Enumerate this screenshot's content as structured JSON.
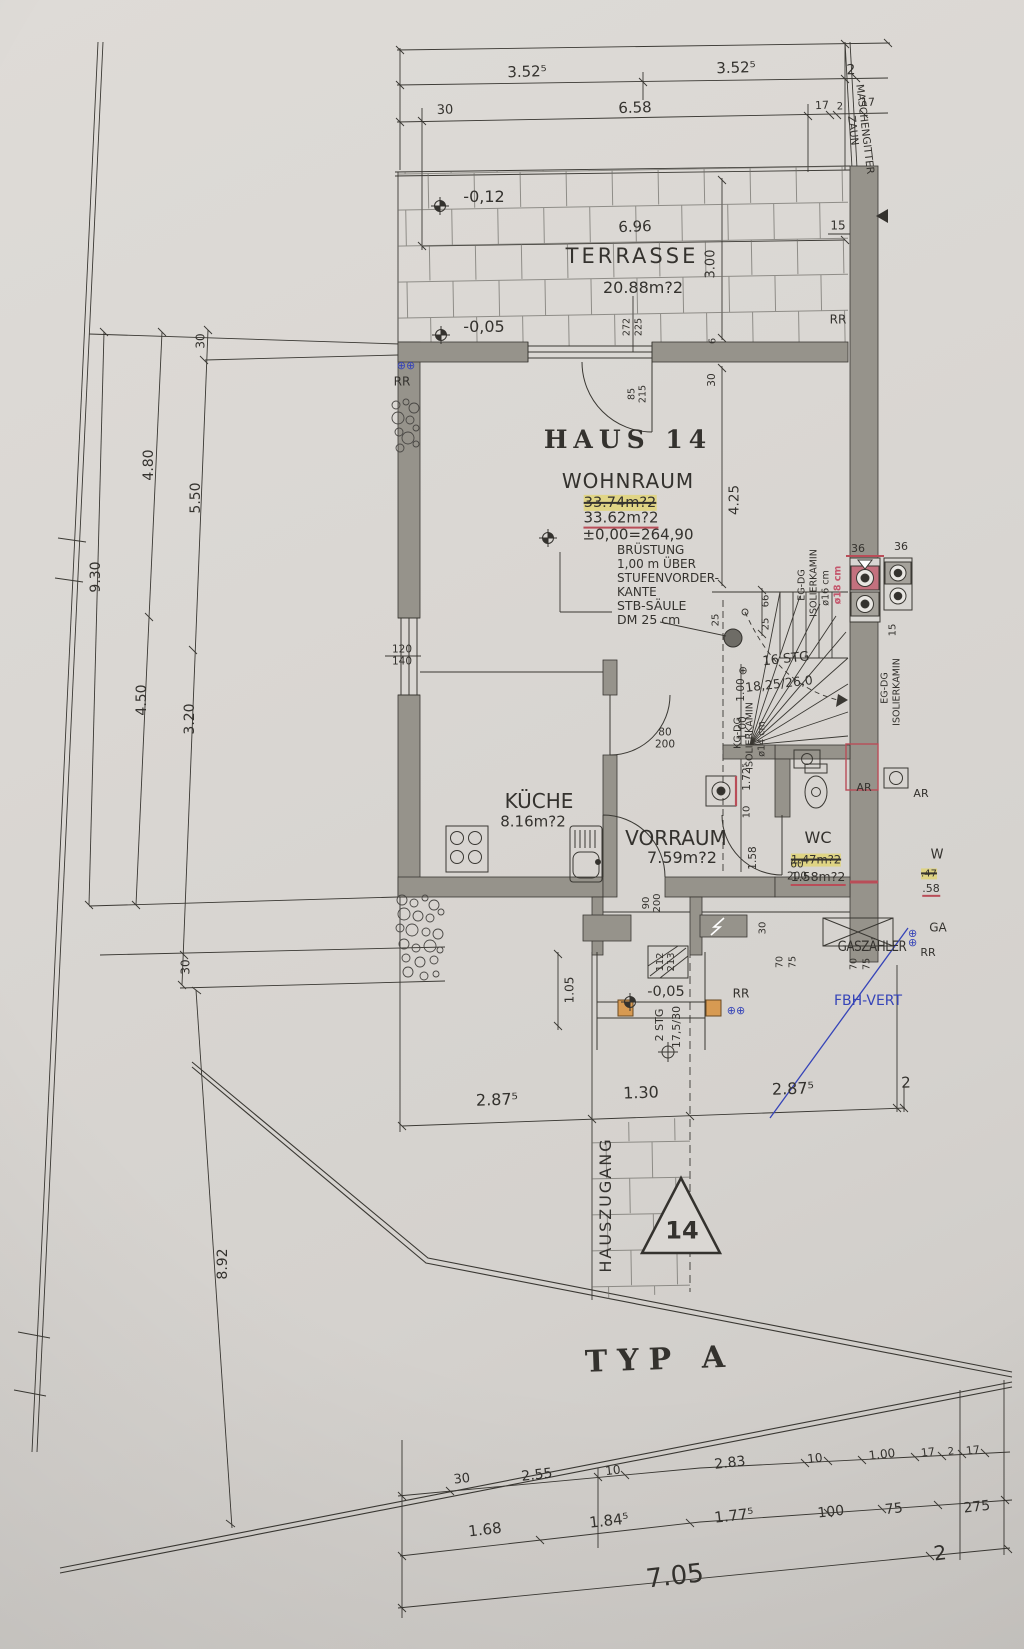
{
  "colors": {
    "paper": "#d9d6d2",
    "ink": "#3a3833",
    "wall": "#96938b",
    "red": "#b94d58",
    "pink": "#c4717e",
    "yellow": "#e6d245",
    "blue": "#3644b8",
    "orange": "#d79a52"
  },
  "labels": {
    "rr": "RR",
    "top": {
      "a": "3.52⁵",
      "b": "3.52⁵",
      "c": "2",
      "d": "30",
      "e": "6.58",
      "f": "17",
      "g": "2",
      "h": "17",
      "fence": "MASCHENGITTER\nZAUN",
      "f15": "15"
    },
    "terrace": {
      "name": "TERRASSE",
      "area": "20.88m?2",
      "lvl1": "-0,12",
      "lvl2": "-0,05",
      "w": "6.96",
      "h": "3.00",
      "a": "272",
      "b": "225",
      "c": "6",
      "d": "30"
    },
    "left": {
      "a": "30",
      "b": "4.80",
      "c": "5.50",
      "d": "9.30",
      "e": "4.50",
      "f": "3.20",
      "g": "30",
      "h": "8.92"
    },
    "house": {
      "title": "HAUS 14",
      "room": "WOHNRAUM",
      "area_old": "33.74m?2",
      "area_new": "33.62m?2",
      "level": "±0,00=264,90",
      "note1": "BRÜSTUNG\n1,00 m ÜBER\nSTUFENVORDER-\nKANTE",
      "note2": "STB-SÄULE\nDM 25 cm",
      "d425": "4.25",
      "door_top": "85\n215",
      "win_left": "120\n140"
    },
    "chimney": {
      "a1": "EG-DG",
      "a2": "ISOLIERKAMIN",
      "a3": "ø16 cm",
      "a4": "ø18 cm",
      "b1": "KG-DG",
      "b2": "ISOLIERKAMIN",
      "b3": "ø14 cm",
      "c1": "EG-DG",
      "c2": "ISOLIERKAMIN",
      "d36a": "36",
      "d36b": "36",
      "d15": "15"
    },
    "stairs": {
      "a": "16 STG",
      "b": "18,25/26,0",
      "d25a": "25",
      "d25b": "25",
      "d66": "66",
      "c1": "1.00",
      "c2": "1.00",
      "c3": "1.72⁵",
      "c4": "10",
      "c5": "1.58",
      "c6": "30"
    },
    "kitchen": {
      "name": "KÜCHE",
      "area": "8.16m?2"
    },
    "vorraum": {
      "name": "VORRAUM",
      "area": "7.59m?2",
      "door": "80\n200"
    },
    "wc": {
      "name": "WC",
      "area_old": "1.47m?2",
      "area_new": "1.58m?2",
      "door": "60\n200",
      "ar": "AR"
    },
    "entrance": {
      "lvl": "-0,05",
      "door": "90\n200",
      "win": "112\n213",
      "steps": "2 STG",
      "ratio": "17,5/30",
      "d105": "1.05"
    },
    "meters": {
      "gas": "GASZÄHLER",
      "fbh": "FBH-VERT",
      "d70": "70",
      "d75": "75"
    },
    "neighbor": {
      "ar": "AR",
      "w": "W",
      "a": ".47",
      "b": ".58",
      "ga": "GA"
    },
    "bottom": {
      "a": "2.87⁵",
      "b": "1.30",
      "c": "2.87⁵",
      "d": "2"
    },
    "walk": {
      "name": "HAUSZUGANG",
      "nr": "14"
    },
    "typ": "TYP A",
    "strip": {
      "u": [
        "30",
        "2.55",
        "10",
        "2.83",
        "10",
        "1.00",
        "17",
        "2",
        "17"
      ],
      "l": [
        "1.68",
        "1.84⁵",
        "1.77⁵",
        "100",
        "75",
        "275"
      ],
      "total": "7.05",
      "d2": "2"
    },
    "icons": {
      "drain": "⊕⊕",
      "target": "⊕"
    }
  }
}
